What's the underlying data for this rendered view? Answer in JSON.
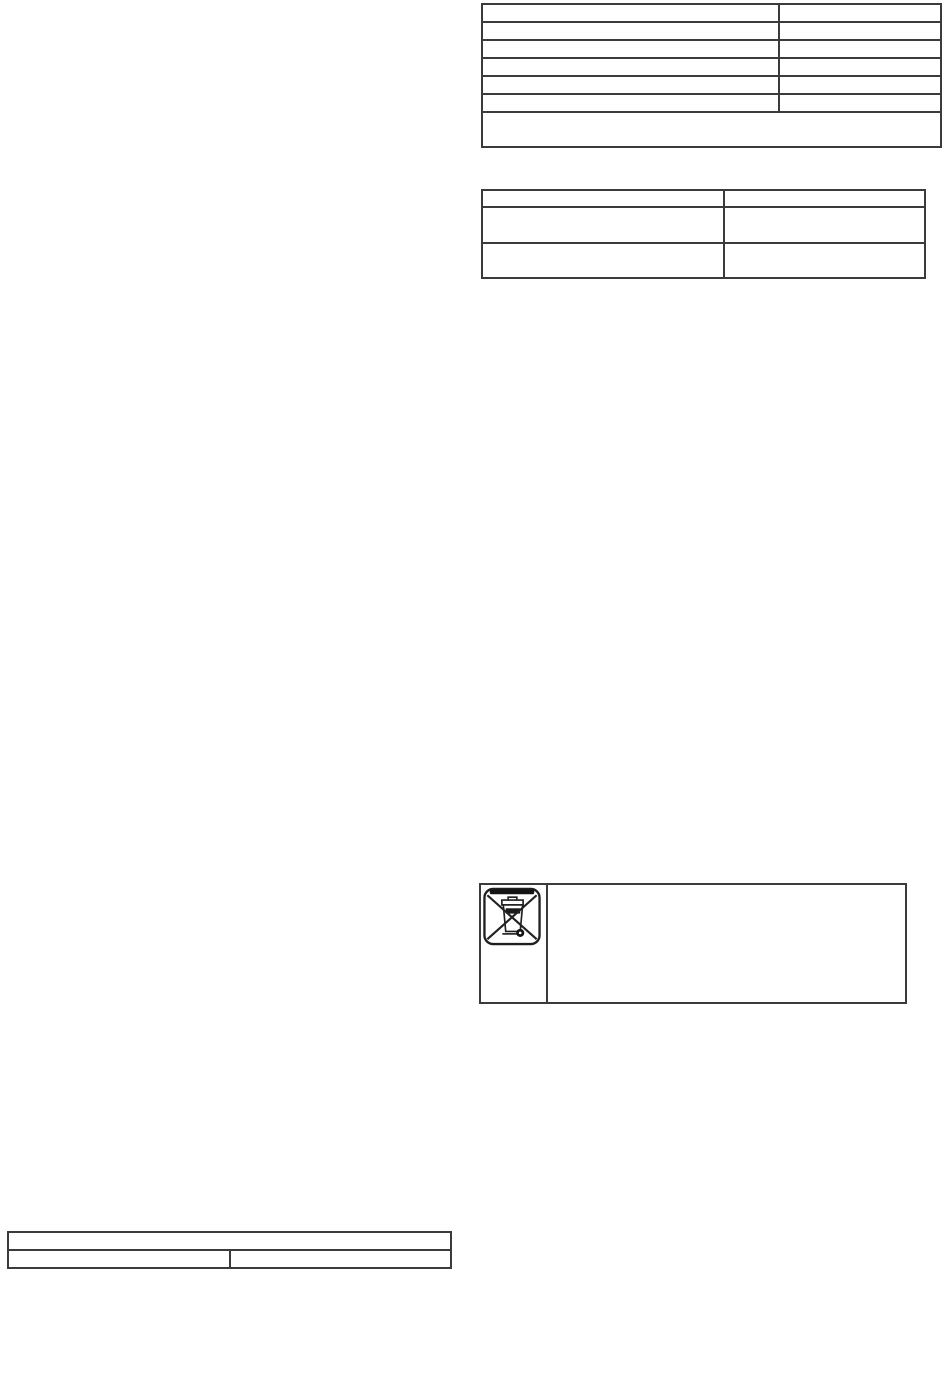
{
  "page": {
    "background": "#ffffff",
    "table_border_color": "#3b3b3b"
  },
  "top_right_table": {
    "rows": [
      [
        "",
        ""
      ],
      [
        "",
        ""
      ],
      [
        "",
        ""
      ],
      [
        "",
        ""
      ],
      [
        "",
        ""
      ],
      [
        "",
        ""
      ]
    ],
    "merged_row": ""
  },
  "mid_right_table": {
    "rows": [
      [
        "",
        ""
      ],
      [
        "",
        ""
      ],
      [
        "",
        ""
      ]
    ]
  },
  "weee_notice": {
    "icon": "weee-crossed-out-wheelie-bin-icon",
    "text": ""
  },
  "bottom_left_table": {
    "merged_row": "",
    "row": [
      "",
      ""
    ]
  }
}
